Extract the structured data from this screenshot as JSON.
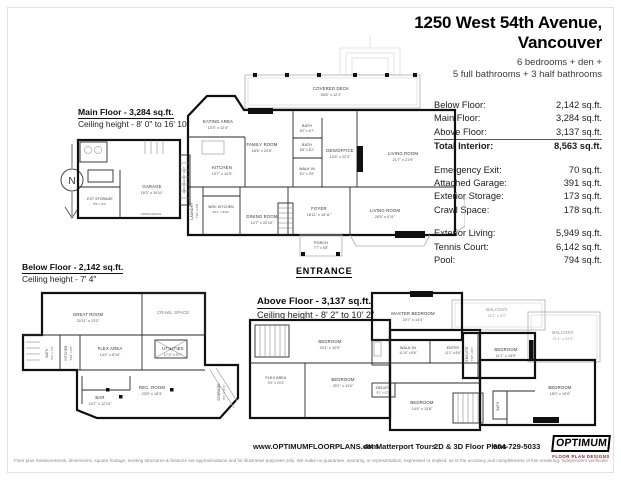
{
  "header": {
    "title_line1": "1250 West 54th Avenue,",
    "title_line2": "Vancouver",
    "subtitle_line1": "6 bedrooms + den +",
    "subtitle_line2": "5 full bathrooms + 3 half bathrooms"
  },
  "stats": {
    "interior": [
      {
        "label": "Below Floor:",
        "value": "2,142 sq.ft."
      },
      {
        "label": "Main Floor:",
        "value": "3,284 sq.ft."
      },
      {
        "label": "Above Floor:",
        "value": "3,137 sq.ft."
      }
    ],
    "total": {
      "label": "Total Interior:",
      "value": "8,563 sq.ft."
    },
    "extras": [
      {
        "label": "Emergency Exit:",
        "value": "70 sq.ft."
      },
      {
        "label": "Attached Garage:",
        "value": "391 sq.ft."
      },
      {
        "label": "Exterior Storage:",
        "value": "173 sq.ft."
      },
      {
        "label": "Crawl Space:",
        "value": "178 sq.ft."
      }
    ],
    "exterior": [
      {
        "label": "Exterior Living:",
        "value": "5,949 sq.ft."
      },
      {
        "label": "Tennis Court:",
        "value": "6,142 sq.ft."
      },
      {
        "label": "Pool:",
        "value": "794 sq.ft."
      }
    ]
  },
  "compass": {
    "label": "N"
  },
  "entrance_label": "ENTRANCE",
  "floors": {
    "main": {
      "title": "Main Floor - 3,284 sq.ft.",
      "ceiling": "Ceiling height - 8' 0\" to 16' 10\"",
      "rooms": [
        {
          "name": "COVERED DECK",
          "dims": "55'8\" x 12'1\""
        },
        {
          "name": "EATING AREA",
          "dims": "13'3\" x 12'4\""
        },
        {
          "name": "FAMILY ROOM",
          "dims": "18'5\" x 24'5\""
        },
        {
          "name": "BATH",
          "dims": "8'2\" x 6'7\""
        },
        {
          "name": "BATH",
          "dims": "5'8\" x 5'2\""
        },
        {
          "name": "WALK IN",
          "dims": "8'2\" x 3'9\""
        },
        {
          "name": "DEN/OFFICE",
          "dims": "13'4\" x 22'2\""
        },
        {
          "name": "LIVING ROOM",
          "dims": "21'7\" x 21'9\""
        },
        {
          "name": "KITCHEN",
          "dims": "15'7\" x 14'9\""
        },
        {
          "name": "LAUNDRY",
          "dims": "7'10\" x 6'8\""
        },
        {
          "name": "WOK KITCHEN",
          "dims": "8'11\" x 6'10\""
        },
        {
          "name": "DINING ROOM",
          "dims": "14'7\" x 22'10\""
        },
        {
          "name": "FOYER",
          "dims": "18'11\" x 16'11\""
        },
        {
          "name": "LIVING ROOM",
          "dims": "26'5\" x 9'11\""
        },
        {
          "name": "PORCH",
          "dims": "7'7\" x 5'8\""
        },
        {
          "name": "GARAGE",
          "dims": "18'2\" x 19'11\""
        },
        {
          "name": "EXT STORAGE",
          "dims": "5'5\" x 8'1\""
        },
        {
          "name": "EMERGENCY EXIT",
          "dims": ""
        },
        {
          "name": "CRAWLSPACE",
          "dims": ""
        }
      ]
    },
    "below": {
      "title": "Below Floor - 2,142 sq.ft.",
      "ceiling": "Ceiling height - 7' 4\"",
      "rooms": [
        {
          "name": "GREAT ROOM",
          "dims": "20'11\" x 13'2\""
        },
        {
          "name": "CRAWL SPACE",
          "dims": ""
        },
        {
          "name": "FLEX AREA",
          "dims": "14'2\" x 8'10\""
        },
        {
          "name": "BATH",
          "dims": "5'2\" x 7'4\""
        },
        {
          "name": "KITCHEN",
          "dims": "5'10\" x 9'5\""
        },
        {
          "name": "UTILITIES",
          "dims": "17'2\" x 9'7\""
        },
        {
          "name": "REC. ROOM",
          "dims": "23'5\" x 18'3\""
        },
        {
          "name": "BAR",
          "dims": "14'7\" x 12'10\""
        },
        {
          "name": "STORAGE",
          "dims": "8'1\" x 10'1\""
        }
      ]
    },
    "above": {
      "title": "Above Floor - 3,137 sq.ft.",
      "ceiling": "Ceiling height - 8' 2\" to 10' 2\"",
      "rooms": [
        {
          "name": "MASTER BEDROOM",
          "dims": "20'7\" x 14'4\""
        },
        {
          "name": "BALCONY",
          "dims": "22'1\" x 9'2\""
        },
        {
          "name": "BALCONY",
          "dims": "21'1\" x 31'9\""
        },
        {
          "name": "BEDROOM",
          "dims": "20'1\" x 10'9\""
        },
        {
          "name": "WALK-IN",
          "dims": "11'10\" x 8'6\""
        },
        {
          "name": "ENTRY",
          "dims": "11'1\" x 8'6\""
        },
        {
          "name": "ENSUITE",
          "dims": "7'10\" x 8'1\""
        },
        {
          "name": "BEDROOM",
          "dims": "11'1\" x 16'9\""
        },
        {
          "name": "FLEX AREA",
          "dims": "9'2\" x 19'4\""
        },
        {
          "name": "BEDROOM",
          "dims": "25'1\" x 11'0\""
        },
        {
          "name": "ENSUITE",
          "dims": "8'1\" x 6'2\""
        },
        {
          "name": "BEDROOM",
          "dims": "14'4\" x 13'8\""
        },
        {
          "name": "BEDROOM",
          "dims": "15'0\" x 19'0\""
        },
        {
          "name": "BATH",
          "dims": ""
        }
      ]
    }
  },
  "footer": {
    "website": "www.OPTIMUMFLOORPLANS.com",
    "tours": "4K Matterport Tours",
    "plans": "2D & 3D Floor Plans",
    "phone": "604-729-5033",
    "logo_title": "OPTIMUM",
    "logo_subtitle": "FLOOR PLAN DESIGNS",
    "disclaimer": "Floor plan measurements, dimensions, square footage, existing structures & features are approximations and for illustrative purposes only. We make no guarantee, warranty, or representation, expressed or implied, as to the accuracy and completeness of this rendering. Independent verification is recommended. E&O Insured for $1,000,000"
  }
}
